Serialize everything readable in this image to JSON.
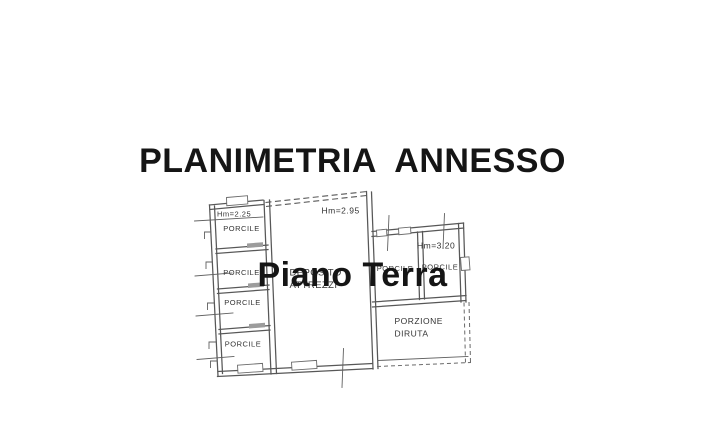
{
  "title": {
    "line1": "PLANIMETRIA  ANNESSO",
    "line2": "Piano Terra"
  },
  "floor_plan": {
    "height_labels": {
      "left_column": "Hm=2.25",
      "deposito": "Hm=2.95",
      "right_wing": "Hm=3.20"
    },
    "left_column_rooms": [
      {
        "label": "PORCILE"
      },
      {
        "label": "PORCILE"
      },
      {
        "label": "PORCILE"
      },
      {
        "label": "PORCILE"
      }
    ],
    "deposito": {
      "line1": "DEPOSITO",
      "line2": "ATTREZZI"
    },
    "right_wing_rooms": [
      {
        "label": "PORCILE"
      },
      {
        "label": "PORCILE"
      }
    ],
    "porzione": {
      "line1": "PORZIONE",
      "line2": "DIRUTA"
    }
  },
  "colors": {
    "background": "#ffffff",
    "title_text": "#151515",
    "wall_line": "#575757",
    "plan_text": "#333333",
    "door_opening": "#9c9c9c"
  }
}
